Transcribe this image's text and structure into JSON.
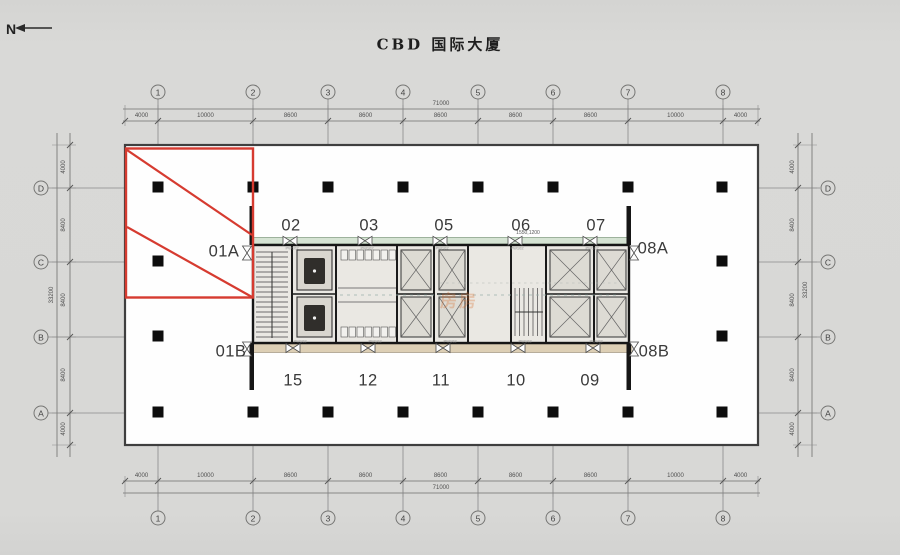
{
  "title": "CBD 国际大厦",
  "north_label": "N",
  "grid": {
    "cols": [
      "1",
      "2",
      "3",
      "4",
      "5",
      "6",
      "7",
      "8"
    ],
    "rows": [
      "D",
      "C",
      "B",
      "A"
    ]
  },
  "dimensions": {
    "top_segments": [
      "4000",
      "10000",
      "8600",
      "8600",
      "8600",
      "8600",
      "8600",
      "10000",
      "4000"
    ],
    "top_total": "71000",
    "bottom_segments": [
      "4000",
      "10000",
      "8600",
      "8600",
      "8600",
      "8600",
      "8600",
      "10000",
      "4000"
    ],
    "bottom_total": "71000",
    "left_segments": [
      "4000",
      "8400",
      "8400",
      "8400",
      "4000"
    ],
    "left_total": "33200",
    "right_segments": [
      "4000",
      "8400",
      "8400",
      "8400",
      "4000"
    ],
    "right_total": "33200"
  },
  "units": {
    "top": [
      "02",
      "03",
      "05",
      "06",
      "07"
    ],
    "bottom": [
      "15",
      "12",
      "11",
      "10",
      "09"
    ],
    "left_top": "01A",
    "left_bottom": "01B",
    "right_top": "08A",
    "right_bottom": "08B"
  },
  "annotations": {
    "small_dim": "1550,1200",
    "door_code": "PW102"
  },
  "watermark": {
    "text": "房房",
    "color": "#e07b2e"
  },
  "colors": {
    "highlight": "#d63b30",
    "core_fill": "#eae8e3",
    "green_band": "#d5e3d3",
    "tan_band": "#ddcfb5",
    "plate": "#fefefe"
  }
}
